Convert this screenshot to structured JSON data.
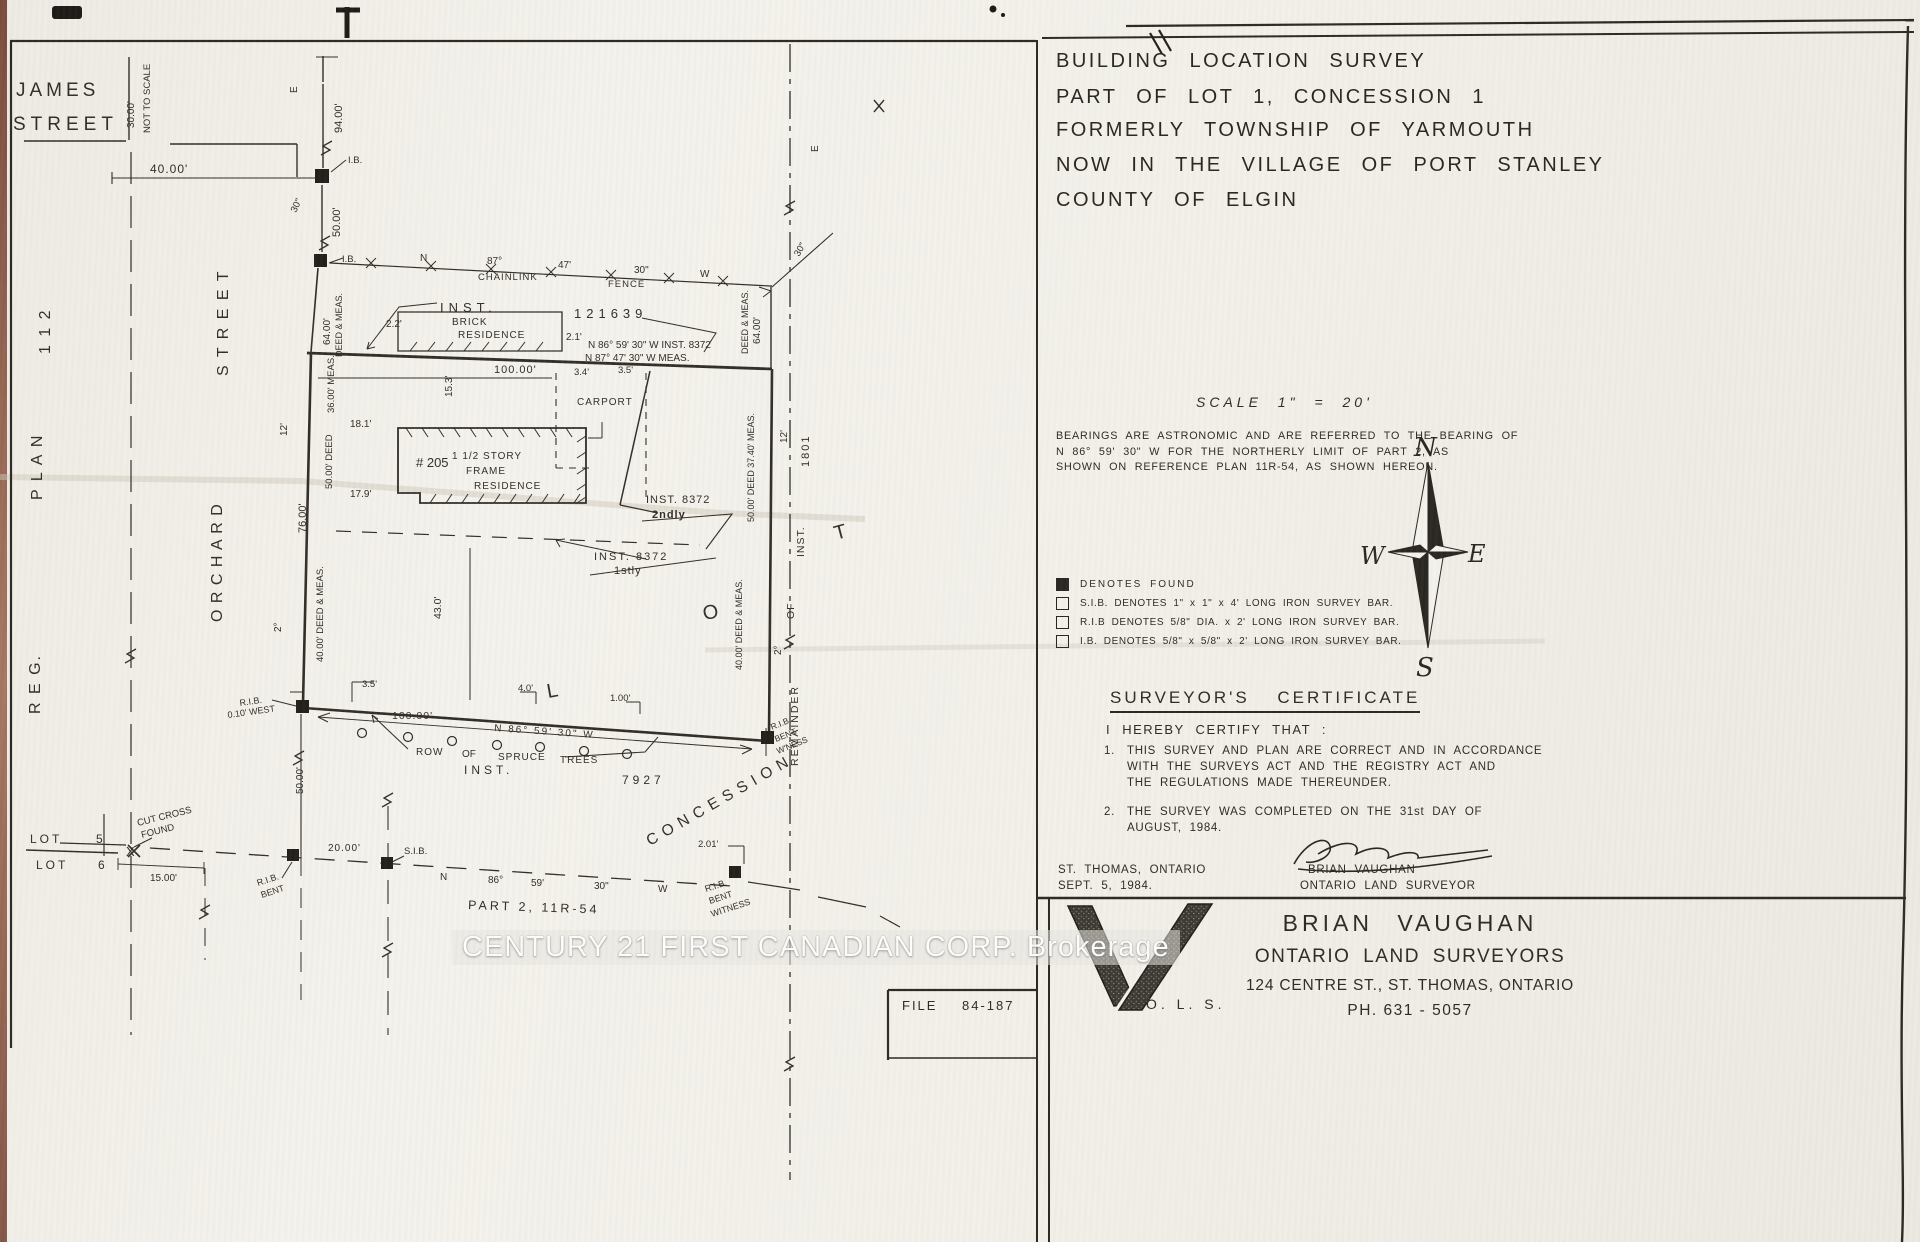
{
  "title_block": {
    "lines": [
      "BUILDING LOCATION SURVEY",
      "PART OF LOT 1, CONCESSION 1",
      "FORMERLY TOWNSHIP OF YARMOUTH",
      "NOW IN THE VILLAGE OF PORT STANLEY",
      "COUNTY OF ELGIN"
    ]
  },
  "scale_note": "SCALE 1\" = 20'",
  "bearings_note": [
    "BEARINGS ARE ASTRONOMIC AND ARE REFERRED TO THE BEARING OF",
    "N 86° 59' 30\" W  FOR THE NORTHERLY LIMIT OF PART 2, AS",
    "SHOWN ON REFERENCE PLAN 11R-54,  AS SHOWN HEREON."
  ],
  "legend": {
    "items": [
      {
        "symbol": "filled-square",
        "text": "DENOTES  FOUND"
      },
      {
        "symbol": "open-square",
        "text": "S.I.B. DENOTES  1\" x 1\" x 4' LONG IRON SURVEY BAR."
      },
      {
        "symbol": "open-square",
        "text": "R.I.B DENOTES  5/8\" DIA. x 2' LONG IRON SURVEY BAR."
      },
      {
        "symbol": "open-square",
        "text": "I.B. DENOTES  5/8\" x 5/8\" x 2' LONG IRON SURVEY BAR."
      }
    ]
  },
  "certificate": {
    "heading": "SURVEYOR'S  CERTIFICATE",
    "intro": "I HEREBY CERTIFY THAT :",
    "items": [
      {
        "num": "1.",
        "lines": [
          "THIS SURVEY AND PLAN ARE CORRECT AND IN ACCORDANCE",
          "WITH THE SURVEYS ACT AND THE REGISTRY ACT AND",
          "THE REGULATIONS MADE THEREUNDER."
        ]
      },
      {
        "num": "2.",
        "lines": [
          "THE SURVEY WAS COMPLETED ON THE 31st DAY OF",
          "AUGUST, 1984."
        ]
      }
    ],
    "place": "ST. THOMAS, ONTARIO",
    "date": "SEPT. 5, 1984.",
    "signer_name": "BRIAN VAUGHAN",
    "signer_title": "ONTARIO LAND SURVEYOR"
  },
  "firm": {
    "logo": "V-monogram",
    "logo_sub": "O. L. S.",
    "name": "BRIAN VAUGHAN",
    "subtitle": "ONTARIO LAND SURVEYORS",
    "address": "124 CENTRE ST., ST. THOMAS, ONTARIO",
    "phone": "PH. 631 - 5057"
  },
  "file_box": {
    "label": "FILE",
    "number": "84-187"
  },
  "watermark": "CENTURY 21 FIRST CANADIAN CORP. Brokerage",
  "drawing": {
    "labels": [
      {
        "t": "JAMES",
        "x": 16,
        "y": 96,
        "fs": 19,
        "ls": 4
      },
      {
        "t": "STREET",
        "x": 13,
        "y": 130,
        "fs": 19,
        "ls": 5
      },
      {
        "t": "30.00'",
        "x": 134,
        "y": 128,
        "r": -90,
        "fs": 10
      },
      {
        "t": "NOT TO SCALE",
        "x": 150,
        "y": 133,
        "r": -90,
        "fs": 9.5
      },
      {
        "t": "R E G.",
        "x": 40,
        "y": 714,
        "r": -90,
        "fs": 16,
        "ls": 2
      },
      {
        "t": "P L A N",
        "x": 42,
        "y": 500,
        "r": -90,
        "fs": 16,
        "ls": 2
      },
      {
        "t": "1 1 2",
        "x": 50,
        "y": 354,
        "r": -90,
        "fs": 16,
        "ls": 2
      },
      {
        "t": "S T R E E T",
        "x": 228,
        "y": 376,
        "r": -90,
        "fs": 16,
        "ls": 2
      },
      {
        "t": "O R C H A R D",
        "x": 222,
        "y": 622,
        "r": -90,
        "fs": 16,
        "ls": 1
      },
      {
        "t": "40.00'",
        "x": 150,
        "y": 173,
        "fs": 12,
        "ls": 1
      },
      {
        "t": "E",
        "x": 297,
        "y": 93,
        "r": -90,
        "fs": 10
      },
      {
        "t": "94.00'",
        "x": 342,
        "y": 133,
        "r": -90,
        "fs": 11
      },
      {
        "t": "I.B.",
        "x": 348,
        "y": 163,
        "fs": 9.5
      },
      {
        "t": "30\"",
        "x": 296,
        "y": 213,
        "r": -65,
        "fs": 9.5
      },
      {
        "t": "50.00'",
        "x": 340,
        "y": 237,
        "r": -90,
        "fs": 11
      },
      {
        "t": "I.B.",
        "x": 342,
        "y": 262,
        "fs": 9.5
      },
      {
        "t": "N",
        "x": 420,
        "y": 261,
        "fs": 10
      },
      {
        "t": "87°",
        "x": 487,
        "y": 264,
        "fs": 10
      },
      {
        "t": "CHAINLINK",
        "x": 478,
        "y": 280,
        "fs": 9.5,
        "ls": 1
      },
      {
        "t": "47'",
        "x": 558,
        "y": 268,
        "fs": 10
      },
      {
        "t": "30\"",
        "x": 634,
        "y": 273,
        "fs": 10
      },
      {
        "t": "FENCE",
        "x": 608,
        "y": 287,
        "fs": 9.5,
        "ls": 1
      },
      {
        "t": "W",
        "x": 700,
        "y": 277,
        "fs": 10
      },
      {
        "t": "INST.",
        "x": 440,
        "y": 312,
        "fs": 13,
        "ls": 5
      },
      {
        "t": "121639",
        "x": 574,
        "y": 318,
        "fs": 13,
        "ls": 5
      },
      {
        "t": "BRICK",
        "x": 452,
        "y": 325,
        "fs": 10,
        "ls": 1
      },
      {
        "t": "RESIDENCE",
        "x": 458,
        "y": 338,
        "fs": 10,
        "ls": 1
      },
      {
        "t": "2.2'",
        "x": 386,
        "y": 327,
        "fs": 10
      },
      {
        "t": "2.1'",
        "x": 566,
        "y": 340,
        "fs": 10
      },
      {
        "t": "N 86° 59' 30\" W  INST. 8372",
        "x": 588,
        "y": 348,
        "fs": 10
      },
      {
        "t": "N 87° 47' 30\" W  MEAS.",
        "x": 585,
        "y": 361,
        "fs": 10
      },
      {
        "t": "100.00'",
        "x": 494,
        "y": 373,
        "fs": 11,
        "ls": 1
      },
      {
        "t": "3.4'",
        "x": 574,
        "y": 375,
        "fs": 9.5
      },
      {
        "t": "3.5'",
        "x": 618,
        "y": 373,
        "fs": 9.5
      },
      {
        "t": "CARPORT",
        "x": 577,
        "y": 405,
        "fs": 10,
        "ls": 1
      },
      {
        "t": "15.3'",
        "x": 452,
        "y": 397,
        "r": -90,
        "fs": 10
      },
      {
        "t": "18.1'",
        "x": 350,
        "y": 427,
        "fs": 10
      },
      {
        "t": "12'",
        "x": 287,
        "y": 436,
        "r": -90,
        "fs": 10
      },
      {
        "t": "36.00' MEAS.",
        "x": 334,
        "y": 413,
        "r": -90,
        "fs": 9.5
      },
      {
        "t": "50.00' DEED",
        "x": 332,
        "y": 489,
        "r": -90,
        "fs": 9.5
      },
      {
        "t": "76.00'",
        "x": 306,
        "y": 533,
        "r": -90,
        "fs": 11
      },
      {
        "t": "2°",
        "x": 281,
        "y": 632,
        "r": -90,
        "fs": 10
      },
      {
        "t": "40.00' DEED & MEAS.",
        "x": 323,
        "y": 662,
        "r": -90,
        "fs": 9.5
      },
      {
        "t": "# 205",
        "x": 416,
        "y": 467,
        "fs": 13
      },
      {
        "t": "1 1/2  STORY",
        "x": 452,
        "y": 459,
        "fs": 10,
        "ls": 1
      },
      {
        "t": "FRAME",
        "x": 466,
        "y": 474,
        "fs": 10,
        "ls": 1
      },
      {
        "t": "RESIDENCE",
        "x": 474,
        "y": 489,
        "fs": 10,
        "ls": 1
      },
      {
        "t": "17.9'",
        "x": 350,
        "y": 497,
        "fs": 10
      },
      {
        "t": "64.00'",
        "x": 330,
        "y": 345,
        "r": -90,
        "fs": 10
      },
      {
        "t": "DEED & MEAS.",
        "x": 342,
        "y": 357,
        "r": -90,
        "fs": 9
      },
      {
        "t": "DEED & MEAS.",
        "x": 748,
        "y": 354,
        "r": -90,
        "fs": 9
      },
      {
        "t": "64.00'",
        "x": 760,
        "y": 344,
        "r": -90,
        "fs": 10
      },
      {
        "t": "30\"",
        "x": 799,
        "y": 257,
        "r": -60,
        "fs": 9.5
      },
      {
        "t": "E",
        "x": 818,
        "y": 152,
        "r": -90,
        "fs": 10
      },
      {
        "t": "INST.  8372",
        "x": 646,
        "y": 503,
        "fs": 11,
        "ls": 1
      },
      {
        "t": "2ndly",
        "x": 652,
        "y": 518,
        "fs": 11,
        "ls": 1,
        "w": 700
      },
      {
        "t": "INST.  8372",
        "x": 594,
        "y": 560,
        "fs": 11,
        "ls": 2
      },
      {
        "t": "1stly",
        "x": 614,
        "y": 574,
        "fs": 11,
        "ls": 1
      },
      {
        "t": "50.00' DEED  37.40' MEAS.",
        "x": 754,
        "y": 522,
        "r": -90,
        "fs": 9
      },
      {
        "t": "40.00' DEED & MEAS.",
        "x": 742,
        "y": 670,
        "r": -90,
        "fs": 9
      },
      {
        "t": "43.0'",
        "x": 441,
        "y": 619,
        "r": -90,
        "fs": 10.5
      },
      {
        "t": "12'",
        "x": 787,
        "y": 443,
        "r": -90,
        "fs": 10
      },
      {
        "t": "1801",
        "x": 809,
        "y": 467,
        "r": -90,
        "fs": 11,
        "ls": 2
      },
      {
        "t": "INST.",
        "x": 804,
        "y": 557,
        "r": -90,
        "fs": 10.5,
        "ls": 1
      },
      {
        "t": "OF",
        "x": 794,
        "y": 619,
        "r": -90,
        "fs": 10.5,
        "ls": 1
      },
      {
        "t": "REMAINDER",
        "x": 798,
        "y": 766,
        "r": -90,
        "fs": 10.5,
        "ls": 2
      },
      {
        "t": "2°",
        "x": 781,
        "y": 655,
        "r": -90,
        "fs": 10
      },
      {
        "t": "T",
        "x": 836,
        "y": 540,
        "fs": 20,
        "r": -15
      },
      {
        "t": "O",
        "x": 704,
        "y": 620,
        "fs": 20,
        "r": -10
      },
      {
        "t": "L",
        "x": 548,
        "y": 698,
        "fs": 20,
        "r": -10
      },
      {
        "t": "3.5'",
        "x": 362,
        "y": 687,
        "fs": 9.5
      },
      {
        "t": "R.I.B.",
        "x": 240,
        "y": 706,
        "fs": 9,
        "r": -8
      },
      {
        "t": "0.10' WEST",
        "x": 228,
        "y": 718,
        "fs": 9,
        "r": -8
      },
      {
        "t": "4.0'",
        "x": 518,
        "y": 691,
        "fs": 9.5
      },
      {
        "t": "1.00'",
        "x": 610,
        "y": 701,
        "fs": 9.5
      },
      {
        "t": "100.00'",
        "x": 392,
        "y": 719,
        "fs": 10.5,
        "ls": 1
      },
      {
        "t": "N  86°  59'  30\"  W",
        "x": 494,
        "y": 731,
        "fs": 10,
        "ls": 2,
        "r": 4
      },
      {
        "t": "ROW",
        "x": 416,
        "y": 755,
        "fs": 10,
        "ls": 1
      },
      {
        "t": "OF",
        "x": 462,
        "y": 757,
        "fs": 10
      },
      {
        "t": "SPRUCE",
        "x": 498,
        "y": 760,
        "fs": 10,
        "ls": 1
      },
      {
        "t": "TREES",
        "x": 560,
        "y": 763,
        "fs": 10,
        "ls": 1
      },
      {
        "t": "INST.",
        "x": 464,
        "y": 774,
        "fs": 12,
        "ls": 4
      },
      {
        "t": "7927",
        "x": 622,
        "y": 784,
        "fs": 12,
        "ls": 4
      },
      {
        "t": "R.I.B.",
        "x": 772,
        "y": 730,
        "fs": 8.5,
        "r": -22
      },
      {
        "t": "BENT",
        "x": 776,
        "y": 742,
        "fs": 8.5,
        "r": -22
      },
      {
        "t": "W'NESS",
        "x": 778,
        "y": 754,
        "fs": 8.5,
        "r": -22
      },
      {
        "t": "50.00'",
        "x": 303,
        "y": 794,
        "r": -90,
        "fs": 10
      },
      {
        "t": "C O N C E S S I O N",
        "x": 650,
        "y": 846,
        "fs": 15.5,
        "ls": 1,
        "r": -30
      },
      {
        "t": "LOT",
        "x": 30,
        "y": 843,
        "fs": 12,
        "ls": 3
      },
      {
        "t": "5",
        "x": 96,
        "y": 843,
        "fs": 12
      },
      {
        "t": "LOT",
        "x": 36,
        "y": 869,
        "fs": 12,
        "ls": 3
      },
      {
        "t": "6",
        "x": 98,
        "y": 869,
        "fs": 12
      },
      {
        "t": "CUT CROSS",
        "x": 138,
        "y": 826,
        "fs": 9.5,
        "r": -14
      },
      {
        "t": "FOUND",
        "x": 142,
        "y": 838,
        "fs": 9.5,
        "r": -14
      },
      {
        "t": "X",
        "x": 126,
        "y": 856,
        "fs": 13
      },
      {
        "t": "15.00'",
        "x": 150,
        "y": 881,
        "fs": 10
      },
      {
        "t": "R.I.B.",
        "x": 258,
        "y": 886,
        "fs": 9,
        "r": -18
      },
      {
        "t": "BENT",
        "x": 262,
        "y": 898,
        "fs": 9,
        "r": -18
      },
      {
        "t": "20.00'",
        "x": 328,
        "y": 851,
        "fs": 10,
        "ls": 1
      },
      {
        "t": "S.I.B.",
        "x": 404,
        "y": 854,
        "fs": 9.5
      },
      {
        "t": "N",
        "x": 440,
        "y": 880,
        "fs": 10
      },
      {
        "t": "86°",
        "x": 488,
        "y": 883,
        "fs": 10
      },
      {
        "t": "59'",
        "x": 531,
        "y": 886,
        "fs": 10
      },
      {
        "t": "30\"",
        "x": 594,
        "y": 889,
        "fs": 10
      },
      {
        "t": "W",
        "x": 658,
        "y": 892,
        "fs": 10
      },
      {
        "t": "PART 2,  11R-54",
        "x": 468,
        "y": 909,
        "fs": 12.5,
        "ls": 3,
        "r": 2
      },
      {
        "t": "2.01'",
        "x": 698,
        "y": 847,
        "fs": 9.5
      },
      {
        "t": "R.I.B.",
        "x": 706,
        "y": 892,
        "fs": 9,
        "r": -18
      },
      {
        "t": "BENT",
        "x": 710,
        "y": 904,
        "fs": 9,
        "r": -18
      },
      {
        "t": "WITNESS",
        "x": 712,
        "y": 917,
        "fs": 9,
        "r": -18
      },
      {
        "t": "N",
        "x": 1414,
        "y": 456,
        "fs": 26,
        "c": "cmp",
        "n": "compass-n-label"
      },
      {
        "t": "S",
        "x": 1416,
        "y": 676,
        "fs": 26,
        "c": "cmp",
        "n": "compass-s-label"
      },
      {
        "t": "E",
        "x": 1468,
        "y": 562,
        "fs": 24,
        "c": "cmp",
        "n": "compass-e-label"
      },
      {
        "t": "W",
        "x": 1360,
        "y": 564,
        "fs": 24,
        "c": "cmp",
        "n": "compass-w-label"
      }
    ]
  }
}
